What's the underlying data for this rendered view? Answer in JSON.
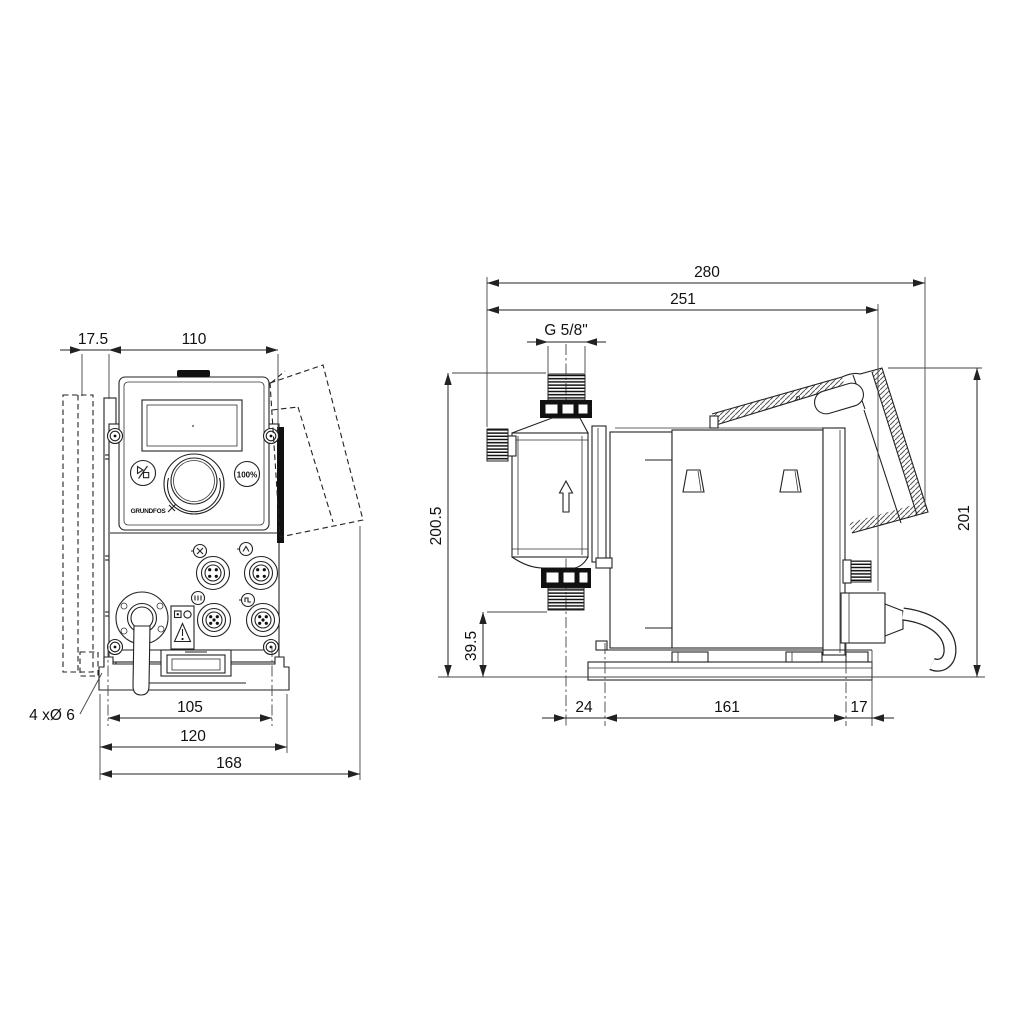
{
  "drawing": {
    "front_view": {
      "dim_offset_left": "17.5",
      "dim_width_top": "110",
      "dim_hole_spacing": "105",
      "dim_plate_width": "120",
      "dim_overall_width": "168",
      "note_mounting_holes": "4 xØ 6"
    },
    "side_view": {
      "dim_overall_depth": "280",
      "dim_depth_to_cable": "251",
      "thread_size": "G 5/8\"",
      "dim_height_to_outlet": "200.5",
      "dim_inlet_height": "39.5",
      "dim_head_to_base": "24",
      "dim_base_length": "161",
      "dim_base_to_back": "17",
      "dim_overall_height": "201"
    },
    "control_panel": {
      "boost_button_label": "100%",
      "brand": "GRUNDFOS"
    },
    "colors": {
      "line": "#222222",
      "background": "#ffffff"
    }
  }
}
